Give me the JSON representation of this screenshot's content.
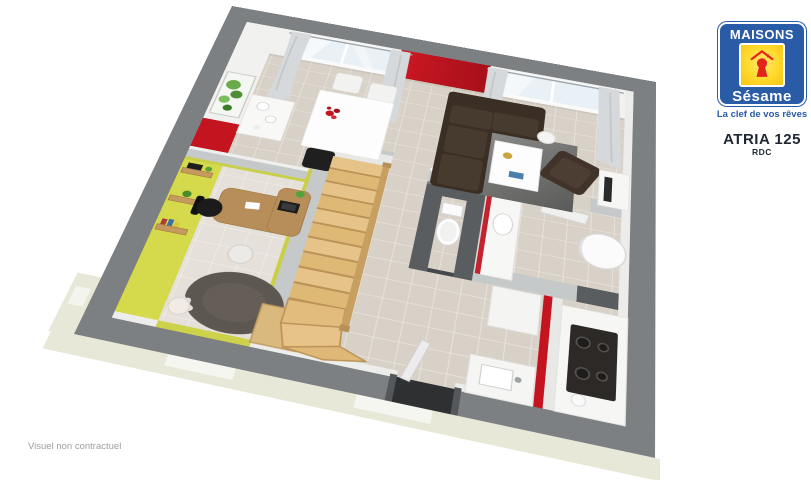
{
  "logo": {
    "brand_top": "MAISONS",
    "brand_bottom": "Sésame",
    "tagline": "La clef de vos rêves",
    "colors": {
      "blue": "#2a5ba6",
      "yellow": "#ffd92b",
      "keyhole_red": "#e2251c"
    }
  },
  "model": {
    "name": "ATRIA 125",
    "level": "RDC"
  },
  "footer": {
    "disclaimer": "Visuel non contractuel"
  },
  "floorplan": {
    "description": "3D ground-floor plan render",
    "rooms": [
      "dining-room",
      "living-room",
      "office",
      "entrance-hall",
      "staircase",
      "wc",
      "bathroom",
      "kitchen"
    ],
    "furniture": [
      "dining-table",
      "dining-chairs",
      "sideboard",
      "vases",
      "plant-picture",
      "window-curtains",
      "corner-sofa",
      "coffee-table",
      "living-rug",
      "armchair",
      "floor-lamp",
      "tv-stand",
      "desk",
      "office-chair",
      "guest-chair",
      "wall-shelves",
      "office-rug",
      "lounge-chair",
      "cube-table",
      "wood-stairs",
      "toilet",
      "vanity-with-red-edge",
      "water-heater",
      "bathroom-door",
      "fridge-column",
      "cooktop",
      "kitchen-sink",
      "red-kitchen-wall",
      "front-door"
    ],
    "colors": {
      "outer_wall": "#7d8082",
      "accent_red": "#c41420",
      "office_yellow": "#d5d94c",
      "floor_tile": "#d8d1c8",
      "office_floor": "#e5e1da",
      "stair_wood": "#e4c185",
      "dark_wall": "#595d60",
      "foundation": "#e8e8d9",
      "sofa_brown": "#3b2f25"
    }
  }
}
